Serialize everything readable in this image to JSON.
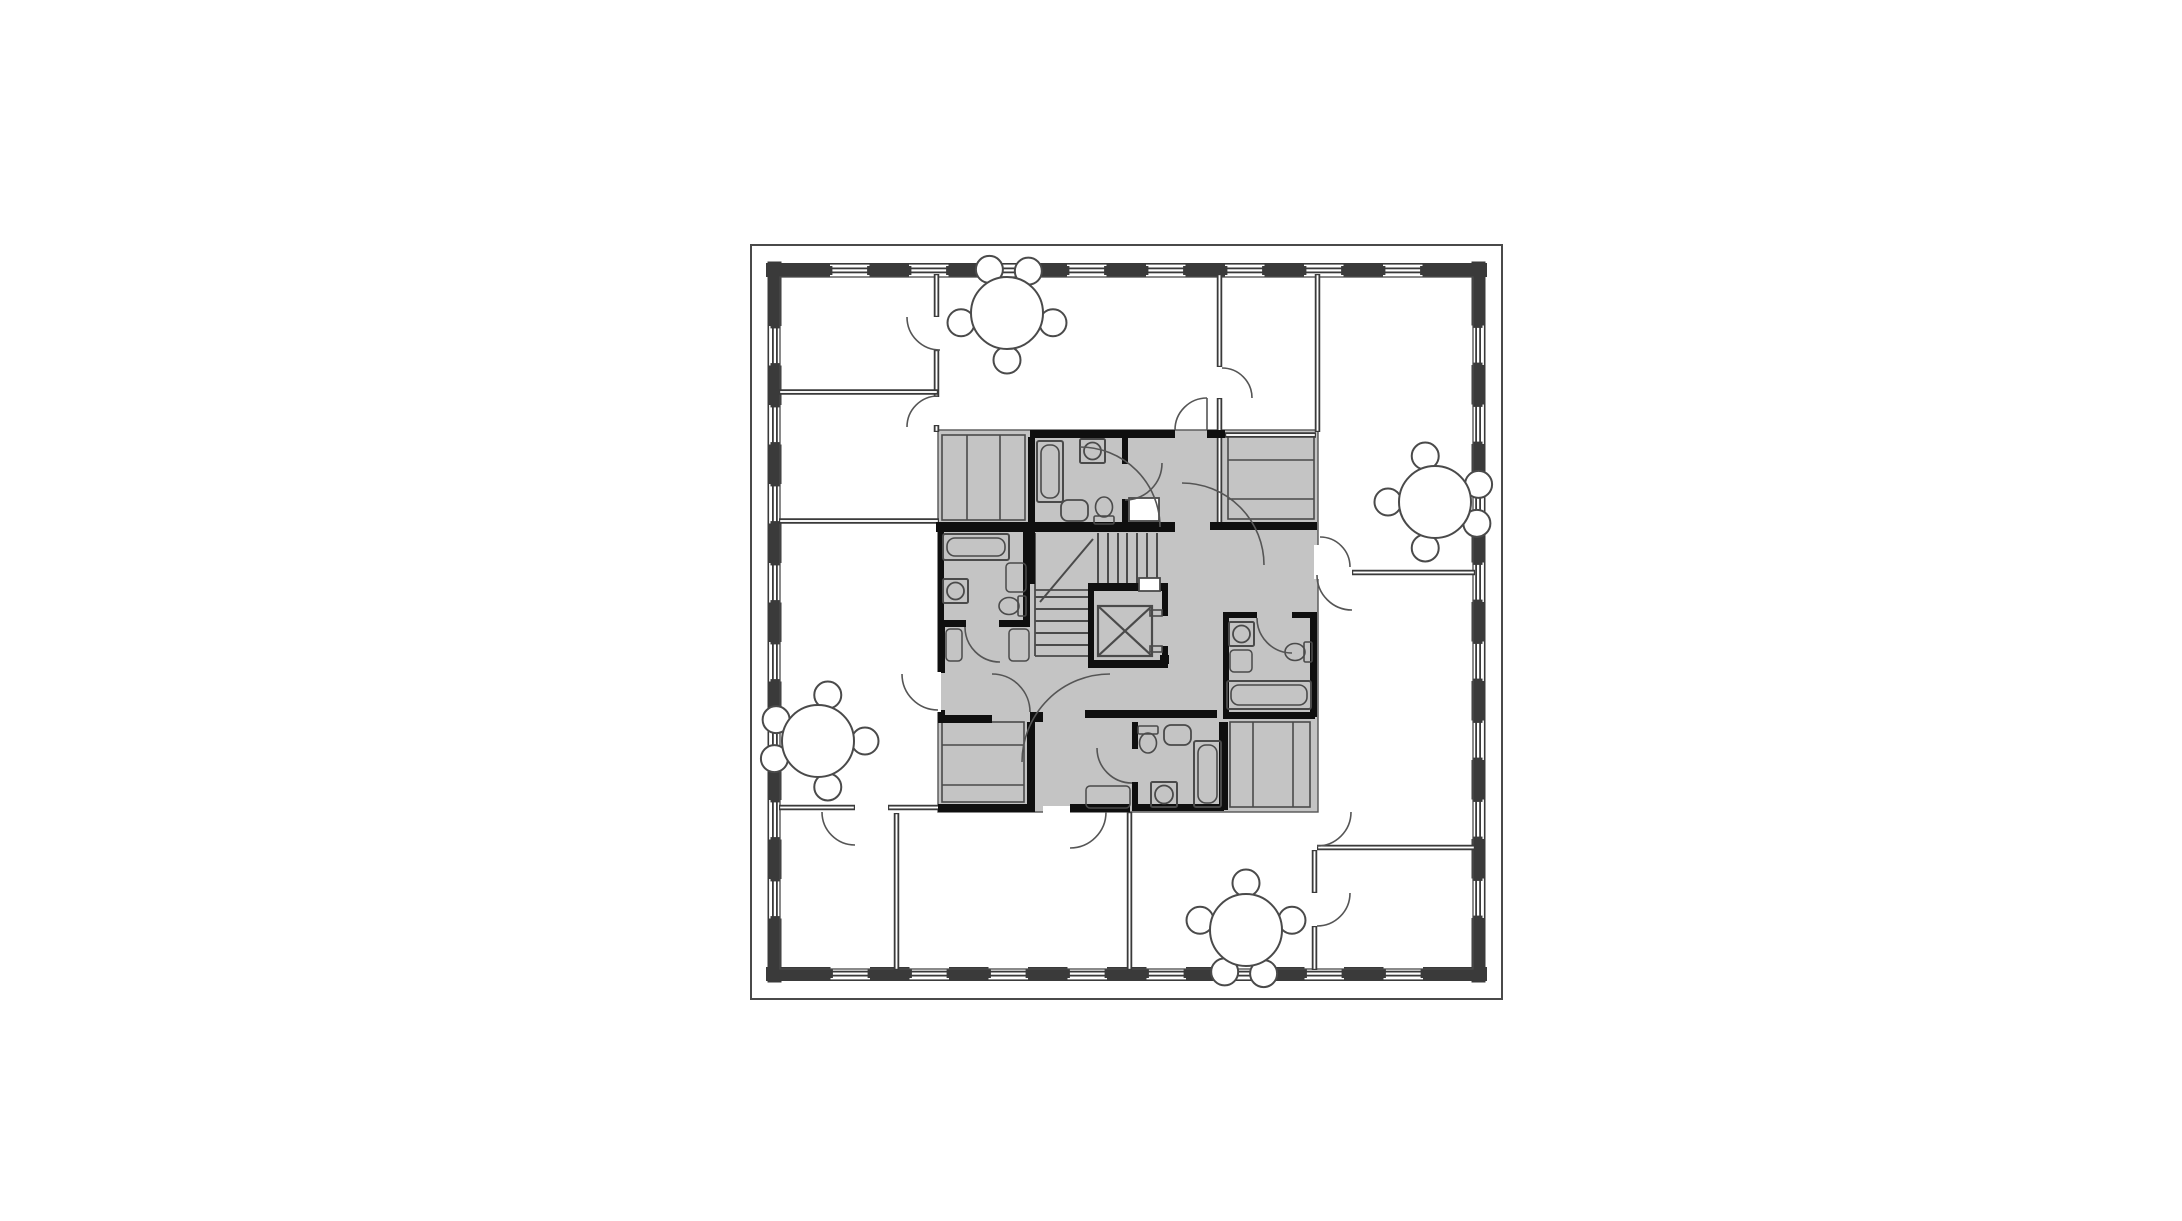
{
  "document": {
    "type": "architectural-floor-plan",
    "description": "Square residential tower floor plan, gray-shaded central service core with stair, elevator, four bathrooms and closets, four apartments with round dining tables"
  },
  "canvas": {
    "w": 2182,
    "h": 1221,
    "bg": "#ffffff"
  },
  "colors": {
    "line": "#4a4a4a",
    "wall": "#3a3a3a",
    "black": "#0f0f0f",
    "gray": "#c4c4c4",
    "white": "#ffffff",
    "thin": "#555555"
  },
  "plan": {
    "center": [
      1126.5,
      622
    ],
    "outer_rect": [
      751,
      245,
      751,
      754
    ],
    "inner_face": [
      780,
      277,
      693,
      692
    ],
    "band": {
      "x0": 766,
      "y0": 263,
      "len": 721,
      "th": 14,
      "window_starts": [
        64,
        143,
        222,
        301,
        380,
        459,
        538,
        617
      ],
      "window_len": 39.5
    },
    "core_rect": [
      938,
      430,
      380,
      382
    ],
    "closets": [
      {
        "rect": [
          942,
          435,
          83,
          85
        ],
        "v": [
          967,
          1000
        ],
        "h": []
      },
      {
        "rect": [
          1228,
          435,
          86,
          84
        ],
        "v": [],
        "h": [
          460,
          499
        ]
      },
      {
        "rect": [
          942,
          722,
          82,
          80
        ],
        "v": [],
        "h": [
          745,
          785
        ]
      },
      {
        "rect": [
          1230,
          722,
          80,
          85
        ],
        "v": [
          1253,
          1293
        ],
        "h": []
      }
    ],
    "stairs": {
      "tread_xs": [
        1098,
        1108,
        1118,
        1127,
        1137,
        1147,
        1157
      ],
      "tread_y": [
        533,
        583
      ],
      "tread_ys": [
        597,
        609,
        621,
        633,
        645
      ],
      "tread_x": [
        1035,
        1088
      ],
      "lines": [
        [
          1035,
          533,
          1035,
          656
        ],
        [
          1035,
          590,
          1088,
          590
        ],
        [
          1035,
          656,
          1088,
          656
        ]
      ],
      "diagonal": [
        1040,
        602,
        1093,
        539
      ]
    },
    "elevator": {
      "walls": [
        [
          1088,
          590,
          6,
          75
        ],
        [
          1162,
          590,
          6,
          26
        ],
        [
          1162,
          646,
          6,
          20
        ],
        [
          1088,
          660,
          80,
          8
        ]
      ],
      "cab": [
        1098,
        606,
        54,
        50
      ],
      "jambs": [
        [
          1150,
          610,
          12,
          6
        ],
        [
          1150,
          646,
          12,
          6
        ]
      ],
      "stub": [
        1160,
        655,
        9,
        9
      ]
    },
    "dwalls": [
      [
        "v",
        936.5,
        274,
        43
      ],
      [
        "v",
        936.5,
        350,
        47
      ],
      [
        "v",
        936.5,
        425,
        7
      ],
      [
        "h",
        779,
        392,
        159
      ],
      [
        "h",
        779,
        521,
        160
      ],
      [
        "v",
        1219.5,
        274,
        93
      ],
      [
        "v",
        1219.5,
        398,
        126
      ],
      [
        "v",
        1317.5,
        274,
        158
      ],
      [
        "h",
        1225,
        435,
        91
      ],
      [
        "h",
        1352,
        572.5,
        123
      ],
      [
        "h",
        779,
        807.5,
        76
      ],
      [
        "h",
        888,
        807.5,
        52
      ],
      [
        "v",
        896.5,
        813,
        157
      ],
      [
        "v",
        1129.5,
        812,
        158
      ],
      [
        "h",
        1317,
        847.5,
        158
      ],
      [
        "v",
        1314.5,
        850,
        43
      ],
      [
        "v",
        1314.5,
        926,
        44
      ]
    ],
    "black_walls": [
      [
        1030,
        430,
        145,
        8
      ],
      [
        1207,
        430,
        18,
        8
      ],
      [
        1028,
        437,
        7,
        87
      ],
      [
        936,
        522,
        239,
        10
      ],
      [
        1122,
        437,
        6,
        27
      ],
      [
        1122,
        499,
        6,
        27
      ],
      [
        938,
        531,
        6,
        90
      ],
      [
        1023,
        531,
        7,
        90
      ],
      [
        938,
        620,
        28,
        7
      ],
      [
        999,
        620,
        31,
        7
      ],
      [
        938,
        627,
        7,
        46
      ],
      [
        938,
        710,
        7,
        8
      ],
      [
        1028,
        528,
        7,
        56
      ],
      [
        1088,
        583,
        80,
        8
      ],
      [
        1210,
        522,
        15,
        8
      ],
      [
        1225,
        522,
        92,
        8
      ],
      [
        1223,
        612,
        34,
        6
      ],
      [
        1292,
        612,
        25,
        6
      ],
      [
        1223,
        618,
        6,
        96
      ],
      [
        1310,
        618,
        7,
        99
      ],
      [
        1223,
        712,
        92,
        7
      ],
      [
        1219,
        722,
        9,
        88
      ],
      [
        1085,
        710,
        132,
        8
      ],
      [
        1132,
        722,
        6,
        27
      ],
      [
        1132,
        782,
        6,
        26
      ],
      [
        1132,
        804,
        92,
        7
      ],
      [
        1070,
        804,
        60,
        8
      ],
      [
        938,
        715,
        54,
        8
      ],
      [
        1030,
        712,
        13,
        10
      ],
      [
        1027,
        722,
        8,
        83
      ],
      [
        938,
        804,
        97,
        8
      ]
    ],
    "white_gaps": [
      [
        934,
        672,
        7,
        40
      ],
      [
        1314,
        545,
        8,
        34
      ],
      [
        1043,
        806,
        27,
        7
      ]
    ],
    "ducts": [
      [
        1129,
        498,
        30,
        23
      ],
      [
        1139,
        578,
        21,
        13
      ]
    ],
    "tubs": [
      [
        1037,
        441,
        26,
        61
      ],
      [
        943,
        534,
        66,
        26
      ],
      [
        1227,
        681,
        84,
        28
      ],
      [
        1194,
        741,
        27,
        66
      ]
    ],
    "sinks": [
      [
        1080,
        439,
        25,
        24
      ],
      [
        943,
        579,
        25,
        24
      ],
      [
        1229,
        622,
        25,
        24
      ],
      [
        1151,
        782,
        26,
        25
      ]
    ],
    "sinks_round": [
      [
        1061,
        500,
        27,
        21
      ],
      [
        1164,
        725,
        27,
        20
      ]
    ],
    "cabinets": [
      [
        1006,
        563,
        20,
        29
      ],
      [
        1230,
        650,
        22,
        22
      ],
      [
        946,
        629,
        16,
        32
      ],
      [
        1009,
        629,
        20,
        32
      ],
      [
        1086,
        786,
        44,
        22
      ]
    ],
    "toilets": [
      [
        1104,
        510,
        0
      ],
      [
        1012,
        606,
        270
      ],
      [
        1298,
        652,
        270
      ],
      [
        1148,
        740,
        180
      ]
    ],
    "doors": [
      [
        940,
        317,
        33,
        90,
        180,
        0
      ],
      [
        938,
        427,
        31,
        180,
        270,
        0
      ],
      [
        1222,
        398,
        30,
        270,
        360,
        0
      ],
      [
        1352,
        575,
        35,
        90,
        180,
        0
      ],
      [
        1320,
        567,
        30,
        270,
        360,
        0
      ],
      [
        1207,
        430,
        32,
        180,
        270,
        1
      ],
      [
        938,
        674,
        36,
        90,
        180,
        0
      ],
      [
        992,
        712,
        38,
        270,
        360,
        0
      ],
      [
        1070,
        812,
        36,
        0,
        90,
        0
      ],
      [
        1317,
        812,
        34,
        0,
        90,
        0
      ],
      [
        1317,
        893,
        33,
        0,
        90,
        0
      ],
      [
        855,
        812,
        33,
        90,
        180,
        0
      ],
      [
        1125,
        463,
        37,
        0,
        90,
        0
      ],
      [
        1000,
        627,
        35,
        90,
        180,
        0
      ],
      [
        1292,
        618,
        35,
        90,
        180,
        0
      ],
      [
        1132,
        748,
        35,
        90,
        180,
        0
      ],
      [
        1080,
        527,
        80,
        270,
        360,
        0
      ],
      [
        1182,
        565,
        82,
        270,
        360,
        0
      ],
      [
        1110,
        762,
        88,
        180,
        270,
        0
      ]
    ],
    "tables": {
      "positions": [
        [
          1007,
          313,
          0
        ],
        [
          1435,
          502,
          90
        ],
        [
          1246,
          930,
          180
        ],
        [
          818,
          741,
          270
        ]
      ],
      "table_r": 36,
      "chair_r": 13.5,
      "chair_dist": 47,
      "chair_angles": [
        -112,
        -63,
        12,
        168,
        90
      ]
    }
  }
}
